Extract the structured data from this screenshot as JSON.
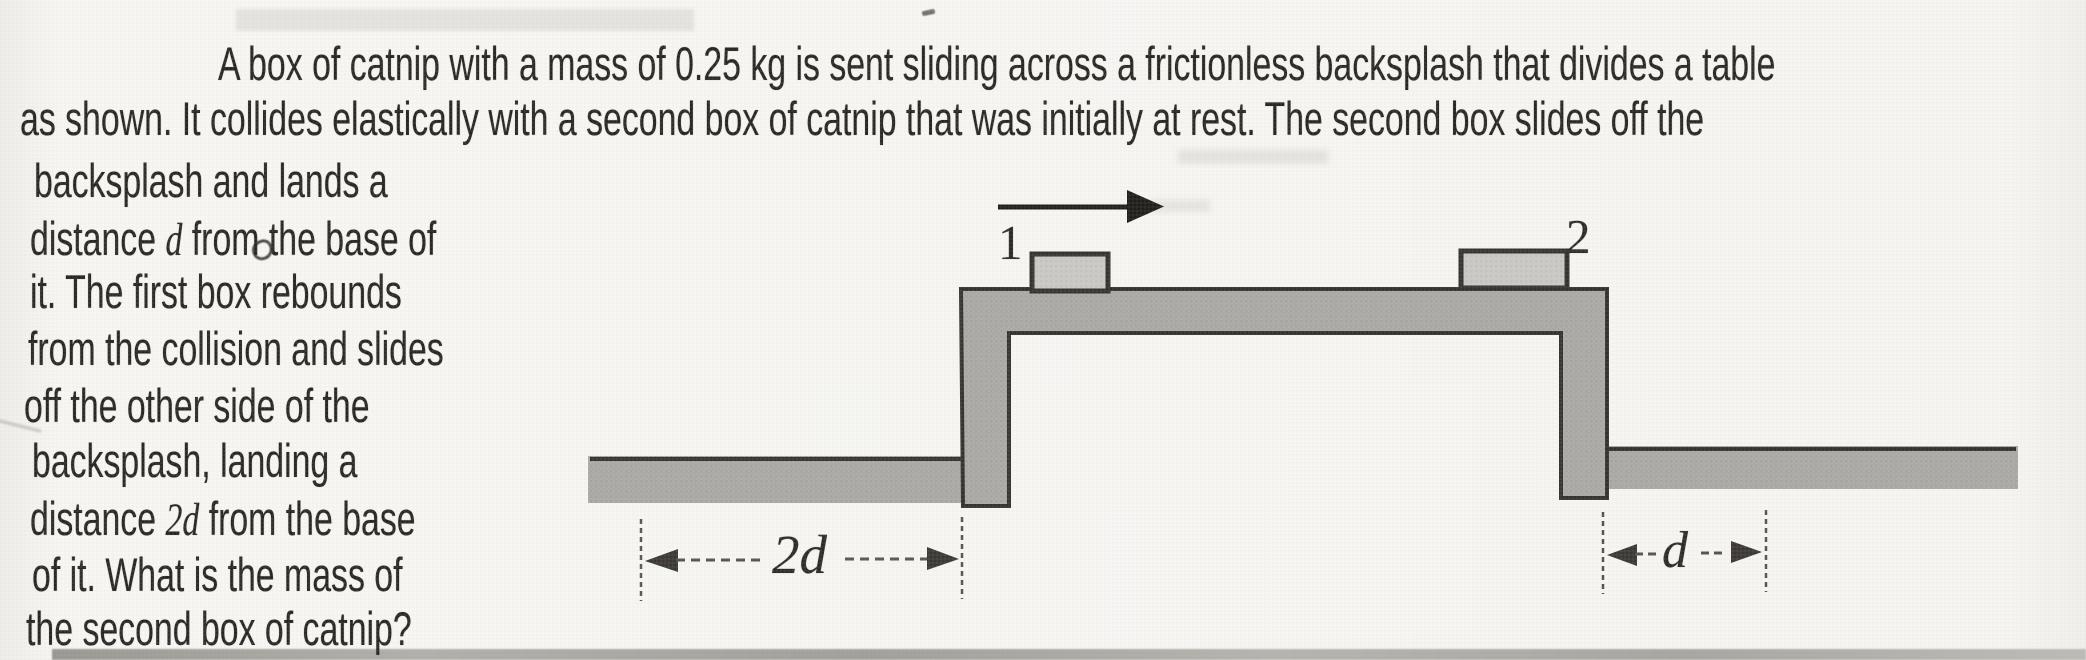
{
  "page": {
    "paper_color": "#f8f7f4",
    "ink_color": "#282622"
  },
  "problem": {
    "lines": [
      {
        "x": 218,
        "y": 36,
        "parts": [
          {
            "t": "A box of catnip with a mass of 0.25 kg is sent sliding across a frictionless backsplash that divides a table"
          }
        ]
      },
      {
        "x": 20,
        "y": 91,
        "parts": [
          {
            "t": "as shown. It collides elastically with a second box of catnip that was initially at rest. The second box slides off the"
          }
        ]
      },
      {
        "x": 34,
        "y": 153,
        "parts": [
          {
            "t": "backsplash and lands a"
          }
        ]
      },
      {
        "x": 30,
        "y": 211,
        "parts": [
          {
            "t": "distance "
          },
          {
            "t": "d",
            "em": true
          },
          {
            "t": " from the base of"
          }
        ]
      },
      {
        "x": 30,
        "y": 264,
        "parts": [
          {
            "t": "it. The first box rebounds"
          }
        ]
      },
      {
        "x": 28,
        "y": 321,
        "parts": [
          {
            "t": "from the collision and slides"
          }
        ]
      },
      {
        "x": 24,
        "y": 378,
        "parts": [
          {
            "t": "off the other side of the"
          }
        ]
      },
      {
        "x": 32,
        "y": 433,
        "parts": [
          {
            "t": "backsplash, landing a"
          }
        ]
      },
      {
        "x": 30,
        "y": 491,
        "parts": [
          {
            "t": "distance "
          },
          {
            "t": "2d",
            "em": true
          },
          {
            "t": " from the base"
          }
        ]
      },
      {
        "x": 32,
        "y": 547,
        "parts": [
          {
            "t": "of it. What is the mass of"
          }
        ]
      },
      {
        "x": 26,
        "y": 601,
        "parts": [
          {
            "t": "the second box of catnip?"
          }
        ]
      }
    ]
  },
  "diagram": {
    "box1_label": "1",
    "box2_label": "2",
    "dim_left_label": "2d",
    "dim_right_label": "d",
    "colors": {
      "surface_gray": "#aeada9",
      "surface_gray_alt": "#a3a29e",
      "outline": "#34322d",
      "box_fill": "#cbcac6",
      "arrow": "#1f1d1a",
      "dim": "#55524c"
    }
  }
}
